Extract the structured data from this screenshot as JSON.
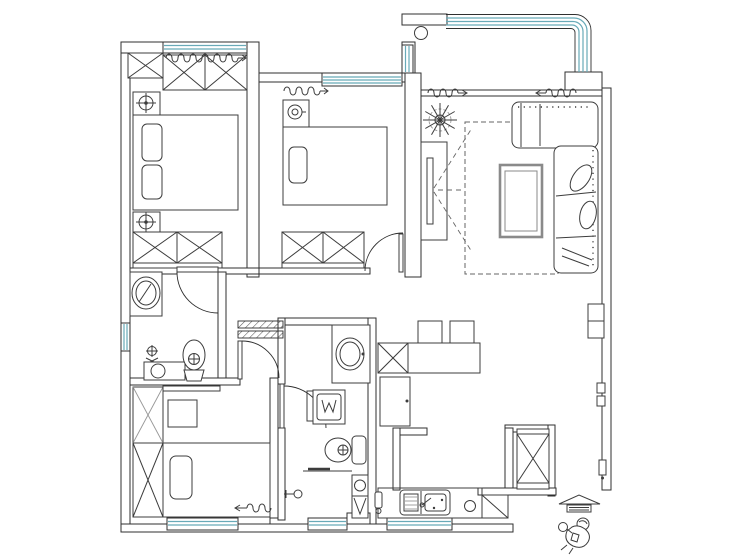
{
  "canvas": {
    "width": 740,
    "height": 555
  },
  "colors": {
    "wall_line": "#2f2f2f",
    "furniture_line": "#3c3c3c",
    "light_line": "#979797",
    "window": "#68aab8",
    "dash": "#666666",
    "background": "#ffffff"
  },
  "drawing": {
    "kind": "apartment-floor-plan",
    "visible_text": [],
    "rooms": [
      {
        "id": "bedroom-1",
        "icons": [
          "sliding-wardrobe-icon",
          "nightstand-lamp-icon",
          "double-bed-icon",
          "pillow-icon",
          "wardrobe-icon",
          "curtain-icon"
        ]
      },
      {
        "id": "bathroom-1",
        "icons": [
          "vanity-basin-icon",
          "mop-sink-icon",
          "toilet-icon",
          "window-icon",
          "door-swing-icon"
        ]
      },
      {
        "id": "bedroom-2",
        "icons": [
          "curtain-icon",
          "nightstand-lamp-icon",
          "double-bed-icon",
          "pillow-icon",
          "wardrobe-icon",
          "door-swing-icon"
        ]
      },
      {
        "id": "bedroom-3",
        "icons": [
          "wardrobe-icon",
          "desk-icon",
          "chair-icon",
          "double-bed-icon",
          "pillow-icon",
          "curtain-icon",
          "window-icon",
          "door-swing-icon"
        ]
      },
      {
        "id": "bathroom-2",
        "icons": [
          "vanity-basin-icon",
          "washing-machine-icon",
          "toilet-icon",
          "shower-head-icon",
          "storage-column-icon",
          "window-icon",
          "door-swing-icon"
        ]
      },
      {
        "id": "hall",
        "icons": [
          "cased-opening-icon"
        ]
      },
      {
        "id": "living-room",
        "icons": [
          "plant-icon",
          "tv-cabinet-icon",
          "tv-icon",
          "rug-icon",
          "coffee-table-icon",
          "sectional-sofa-icon",
          "throw-pillow-icon",
          "curtain-icon"
        ]
      },
      {
        "id": "dining-area",
        "icons": [
          "dining-table-icon",
          "chair-icon",
          "storage-cabinet-icon",
          "refrigerator-icon"
        ]
      },
      {
        "id": "kitchen",
        "icons": [
          "counter-icon",
          "double-sink-icon",
          "burner-icon",
          "corner-cabinet-icon",
          "floor-drain-icon",
          "window-icon"
        ]
      },
      {
        "id": "balcony",
        "icons": [
          "curved-window-icon",
          "column-icon"
        ]
      },
      {
        "id": "entry",
        "icons": [
          "shoe-cabinet-icon",
          "door-handle-icon",
          "wall-shelf-icon",
          "entrance-canopy-icon",
          "steps-icon",
          "person-figure-icon"
        ]
      }
    ]
  }
}
